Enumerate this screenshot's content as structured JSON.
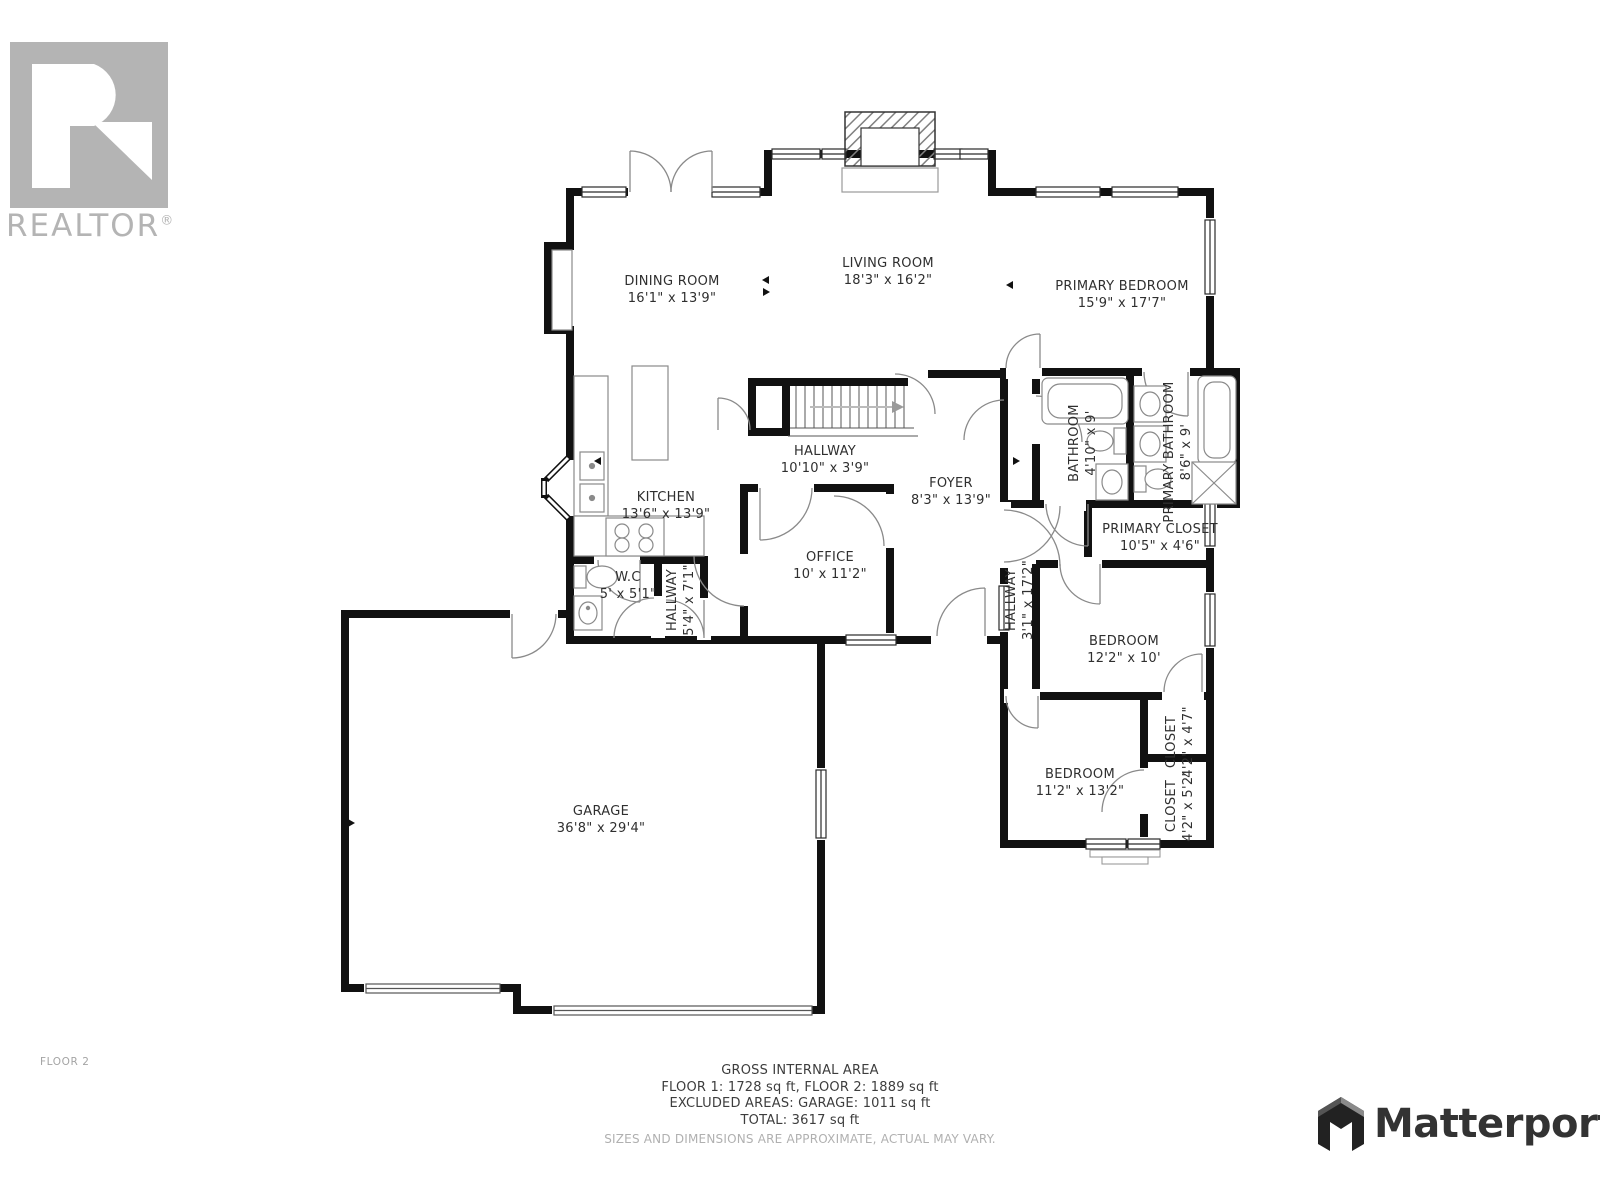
{
  "branding": {
    "realtor": {
      "wordmark": "REALTOR",
      "registered": "®"
    },
    "matterport": {
      "wordmark": "Matterport"
    }
  },
  "floor_label": "FLOOR 2",
  "footer": {
    "title": "GROSS INTERNAL AREA",
    "floors": "FLOOR 1: 1728 sq ft, FLOOR 2: 1889 sq ft",
    "excluded": "EXCLUDED AREAS: GARAGE: 1011 sq ft",
    "total": "TOTAL: 3617 sq ft",
    "disclaimer": "SIZES AND DIMENSIONS ARE APPROXIMATE, ACTUAL MAY VARY."
  },
  "rooms": [
    {
      "name": "DINING ROOM",
      "dims": "16'1\" x 13'9\""
    },
    {
      "name": "LIVING ROOM",
      "dims": "18'3\" x 16'2\""
    },
    {
      "name": "PRIMARY BEDROOM",
      "dims": "15'9\" x 17'7\""
    },
    {
      "name": "BATHROOM",
      "dims": "4'10\" x 9'"
    },
    {
      "name": "PRIMARY BATHROOM",
      "dims": "8'6\" x 9'"
    },
    {
      "name": "PRIMARY CLOSET",
      "dims": "10'5\" x 4'6\""
    },
    {
      "name": "HALLWAY",
      "dims": "3'1\" x 17'2\""
    },
    {
      "name": "BEDROOM",
      "dims": "12'2\" x 10'"
    },
    {
      "name": "CLOSET",
      "dims": "4'2\" x 4'7\""
    },
    {
      "name": "CLOSET",
      "dims": "4'2\" x 5'2\""
    },
    {
      "name": "BEDROOM",
      "dims": "11'2\" x 13'2\""
    },
    {
      "name": "KITCHEN",
      "dims": "13'6\" x 13'9\""
    },
    {
      "name": "HALLWAY",
      "dims": "10'10\" x 3'9\""
    },
    {
      "name": "FOYER",
      "dims": "8'3\" x 13'9\""
    },
    {
      "name": "OFFICE",
      "dims": "10' x 11'2\""
    },
    {
      "name": "W.C",
      "dims": "5' x 5'1\""
    },
    {
      "name": "HALLWAY",
      "dims": "5'4\" x 7'1\""
    },
    {
      "name": "GARAGE",
      "dims": "36'8\" x 29'4\""
    }
  ],
  "colors": {
    "wall": "#111111",
    "fixture_line": "#8a8a8a",
    "label_text": "#2f2f2f",
    "muted_text": "#b0b0b0",
    "logo_gray": "#b4b4b4",
    "matterport_dark": "#2e2e2e"
  }
}
